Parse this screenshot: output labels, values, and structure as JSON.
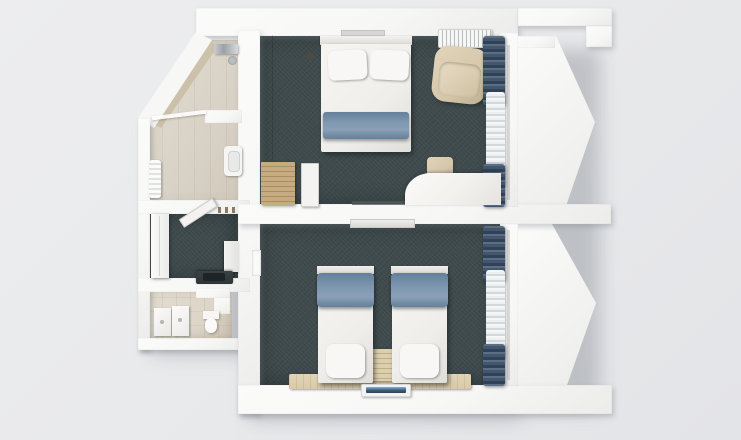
{
  "scene": {
    "title": "Hotel suite floor plan - 3D top-down render",
    "view": "top-down",
    "rooms_count": 7
  },
  "palette": {
    "bg": "#e9eaec",
    "wall": "#f7f7f6",
    "carpet": "#3e4a4c",
    "bathtile": "#d8d1c5",
    "woodlight": "#d9c9a7",
    "woodrim": "#7d5034",
    "terracotta": "#c5805f",
    "bedwhite": "#efeeeb",
    "runner": "#7e96af",
    "curtain": "#43566b",
    "sheer": "#edf0f1",
    "beige": "#d6c7ab",
    "tvscreen": "#3d5a78",
    "counter": "#2e3537"
  },
  "rooms": [
    {
      "id": "bathroom-top",
      "label": "Bathroom with shower",
      "floor": "beige tile",
      "items": [
        "shower fixture",
        "glass partition",
        "washbasin",
        "towel radiator",
        "open door"
      ]
    },
    {
      "id": "entry-hall",
      "label": "Entry hall",
      "floor": "dark carpet",
      "items": [
        "closet",
        "fridge cabinet",
        "kitchenette counter with sink",
        "coat hooks"
      ]
    },
    {
      "id": "bathroom-bottom",
      "label": "WC washroom",
      "floor": "beige tile",
      "items": [
        "toilet",
        "vanity unit",
        "vanity unit",
        "partition wall"
      ]
    },
    {
      "id": "bedroom-1",
      "label": "Bedroom with double bed",
      "floor": "dark carpet",
      "items": [
        "wardrobe",
        "luggage bench",
        "double bed with blue runner",
        "nightstand with lamp",
        "nightstand",
        "AC grille",
        "armchair",
        "desk",
        "stool",
        "open door",
        "dark curtains",
        "sheer curtains"
      ]
    },
    {
      "id": "bedroom-2",
      "label": "Twin bedroom",
      "floor": "dark carpet",
      "items": [
        "single bed with blue runner",
        "single bed with blue runner",
        "bedside cabinet",
        "headboard panel",
        "wall TV",
        "dark curtains",
        "sheer curtains"
      ]
    },
    {
      "id": "balcony-1",
      "label": "Balcony (angled bay)",
      "floor": "terracotta tile",
      "items": [
        "round table",
        "chair",
        "chair",
        "wood handrail",
        "white parapet"
      ]
    },
    {
      "id": "balcony-2",
      "label": "Balcony (angled bay)",
      "floor": "terracotta tile",
      "items": [
        "round table",
        "chair",
        "chair",
        "wood handrail",
        "white parapet"
      ]
    }
  ]
}
